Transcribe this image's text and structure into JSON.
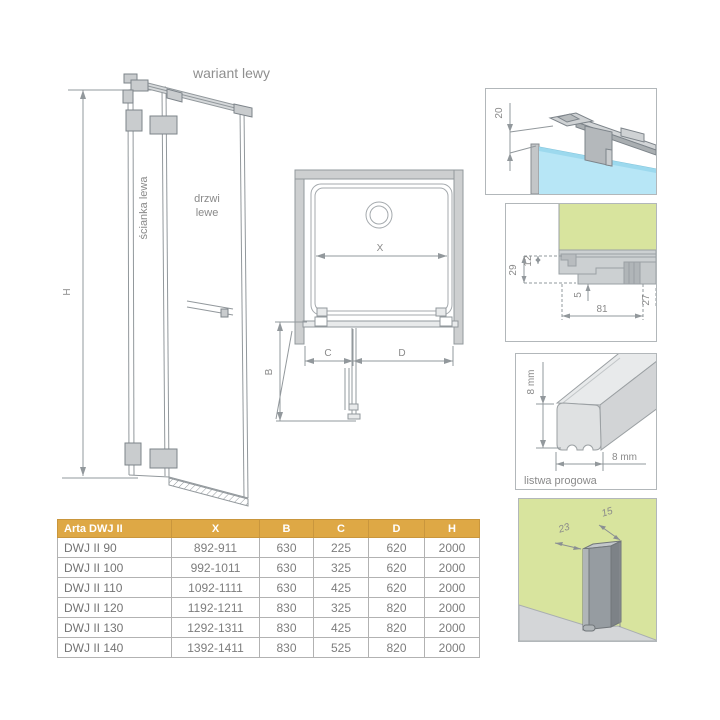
{
  "drawing": {
    "variant_label": "wariant lewy",
    "front": {
      "wall_label": "ścianka lewa",
      "door_label_line1": "drzwi",
      "door_label_line2": "lewe",
      "height_dim": "H"
    },
    "plan": {
      "width_dim": "X",
      "swing_dim": "B",
      "fixed_dim": "C",
      "door_dim": "D"
    }
  },
  "details": {
    "top_clamp": {
      "bar_offset_dim": "20"
    },
    "wall_section": {
      "dim_total_height": "29",
      "dim_glass": "12",
      "dim_lip": "5",
      "dim_profile_width": "81",
      "dim_end": "27"
    },
    "threshold": {
      "caption": "listwa progowa",
      "height_dim": "8 mm",
      "width_dim": "8 mm"
    },
    "wall_profile": {
      "depth_dim": "23",
      "width_dim": "15"
    }
  },
  "table": {
    "headers": [
      "Arta DWJ II",
      "X",
      "B",
      "C",
      "D",
      "H"
    ],
    "rows": [
      [
        "DWJ II 90",
        "892-911",
        "630",
        "225",
        "620",
        "2000"
      ],
      [
        "DWJ II 100",
        "992-1011",
        "630",
        "325",
        "620",
        "2000"
      ],
      [
        "DWJ II 110",
        "1092-1111",
        "630",
        "425",
        "620",
        "2000"
      ],
      [
        "DWJ II 120",
        "1192-1211",
        "830",
        "325",
        "820",
        "2000"
      ],
      [
        "DWJ II 130",
        "1292-1311",
        "830",
        "425",
        "820",
        "2000"
      ],
      [
        "DWJ II 140",
        "1392-1411",
        "830",
        "525",
        "820",
        "2000"
      ]
    ]
  },
  "colors": {
    "accent_gold": "#dea845",
    "wall_green": "#d8e49e",
    "glass_blue": "#b7e6f6",
    "line_grey": "#92989c"
  }
}
